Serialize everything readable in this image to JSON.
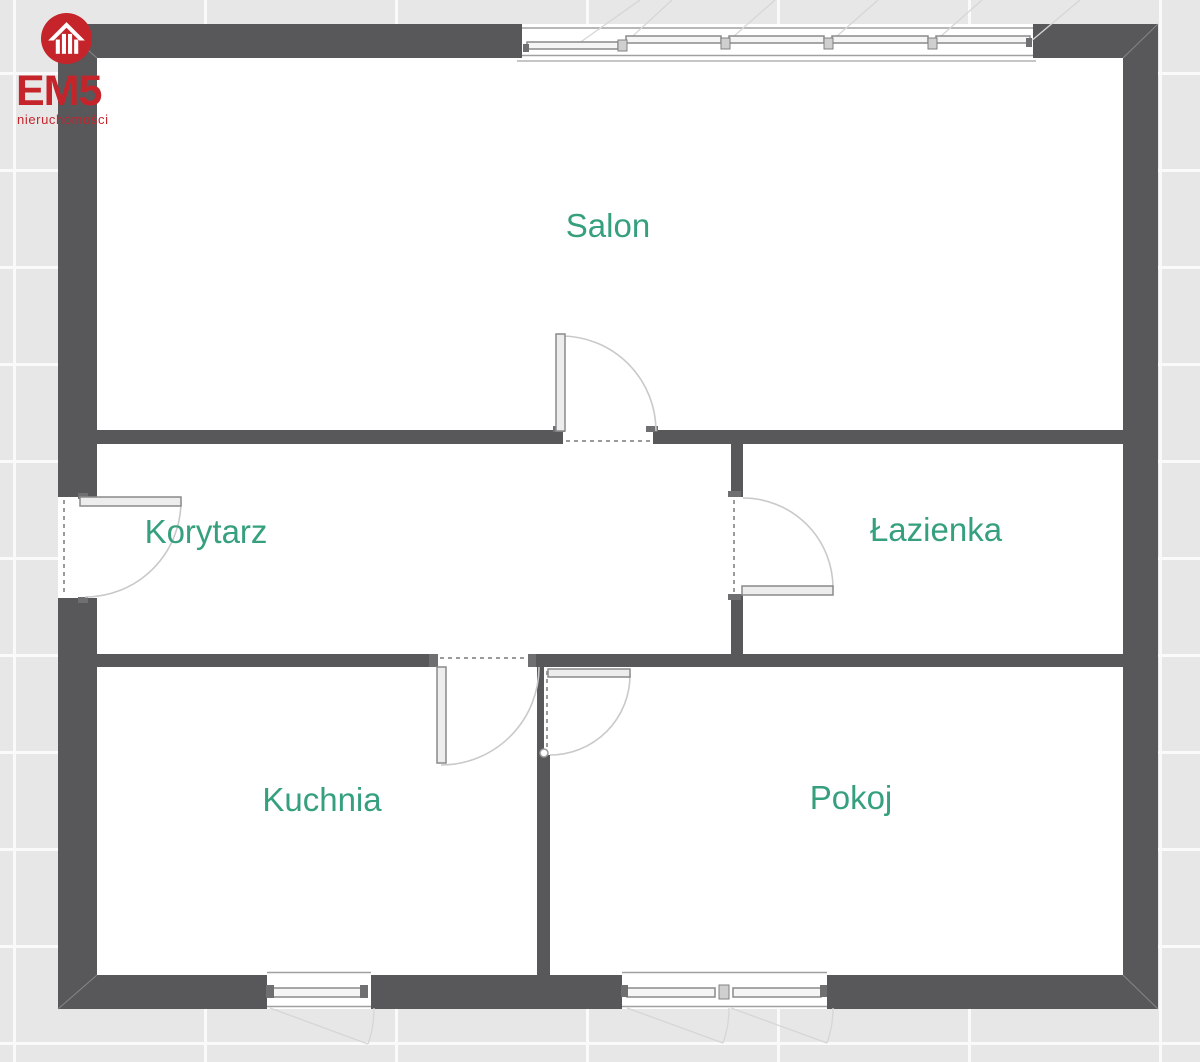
{
  "logo": {
    "brand": "EM5",
    "tagline": "nieruchomości",
    "icon": "house-icon"
  },
  "rooms": [
    {
      "name": "salon",
      "label": "Salon"
    },
    {
      "name": "korytarz",
      "label": "Korytarz"
    },
    {
      "name": "lazienka",
      "label": "Łazienka"
    },
    {
      "name": "kuchnia",
      "label": "Kuchnia"
    },
    {
      "name": "pokoj",
      "label": "Pokoj"
    }
  ],
  "features": {
    "doors": [
      "entrance-door",
      "salon-door",
      "lazienka-door",
      "kuchnia-door",
      "pokoj-door"
    ],
    "windows": [
      "salon-top-window-5-pane",
      "kuchnia-bottom-window",
      "pokoj-bottom-window-2-pane"
    ]
  },
  "colors": {
    "wall": "#58585a",
    "interior": "#ffffff",
    "tile": "#e7e7e7",
    "grout": "#fafafa",
    "label": "#36a07e",
    "red": "#c5242b",
    "line": "#9a9a9a",
    "arc": "#c9c9c9"
  }
}
